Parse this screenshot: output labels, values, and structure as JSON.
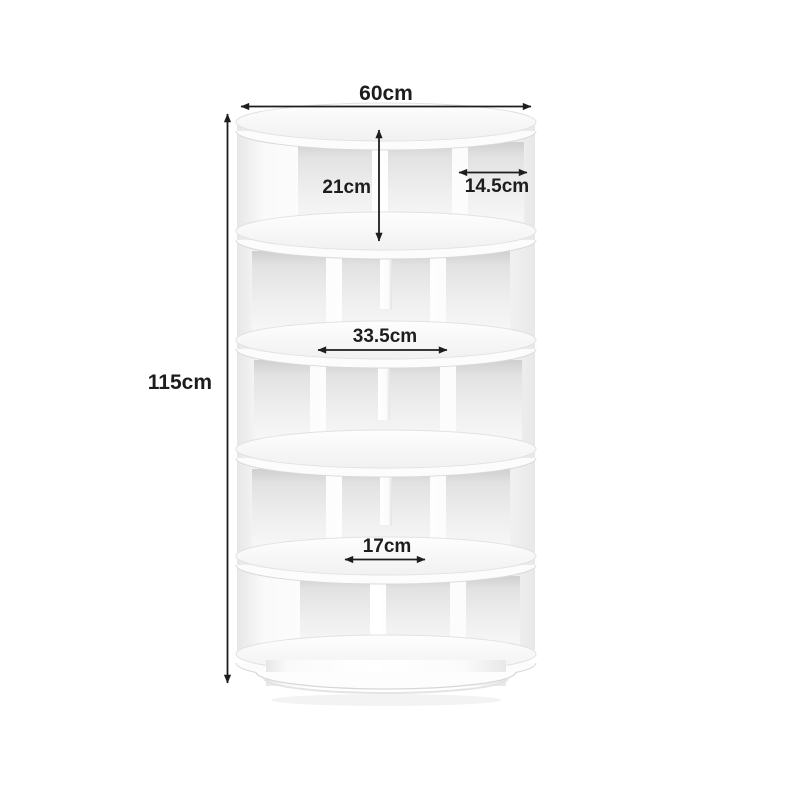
{
  "page": {
    "background": "#ffffff"
  },
  "palette": {
    "page_bg": "#ffffff",
    "annotation": "#1d1d1d",
    "product_body": "#ffffff",
    "product_shade_light": "#f2f2f2",
    "product_shade_mid": "#e0e0e0",
    "product_outline": "#d8d8d8"
  },
  "product": {
    "kind": "rotating cylindrical shoe rack",
    "tier_count": 5
  },
  "dimensions": {
    "top_width": "60cm",
    "total_height": "115cm",
    "tier_inner_height": "21cm",
    "side_compartment_width": "14.5cm",
    "shelf_depth": "33.5cm",
    "center_compartment_width": "17cm"
  }
}
